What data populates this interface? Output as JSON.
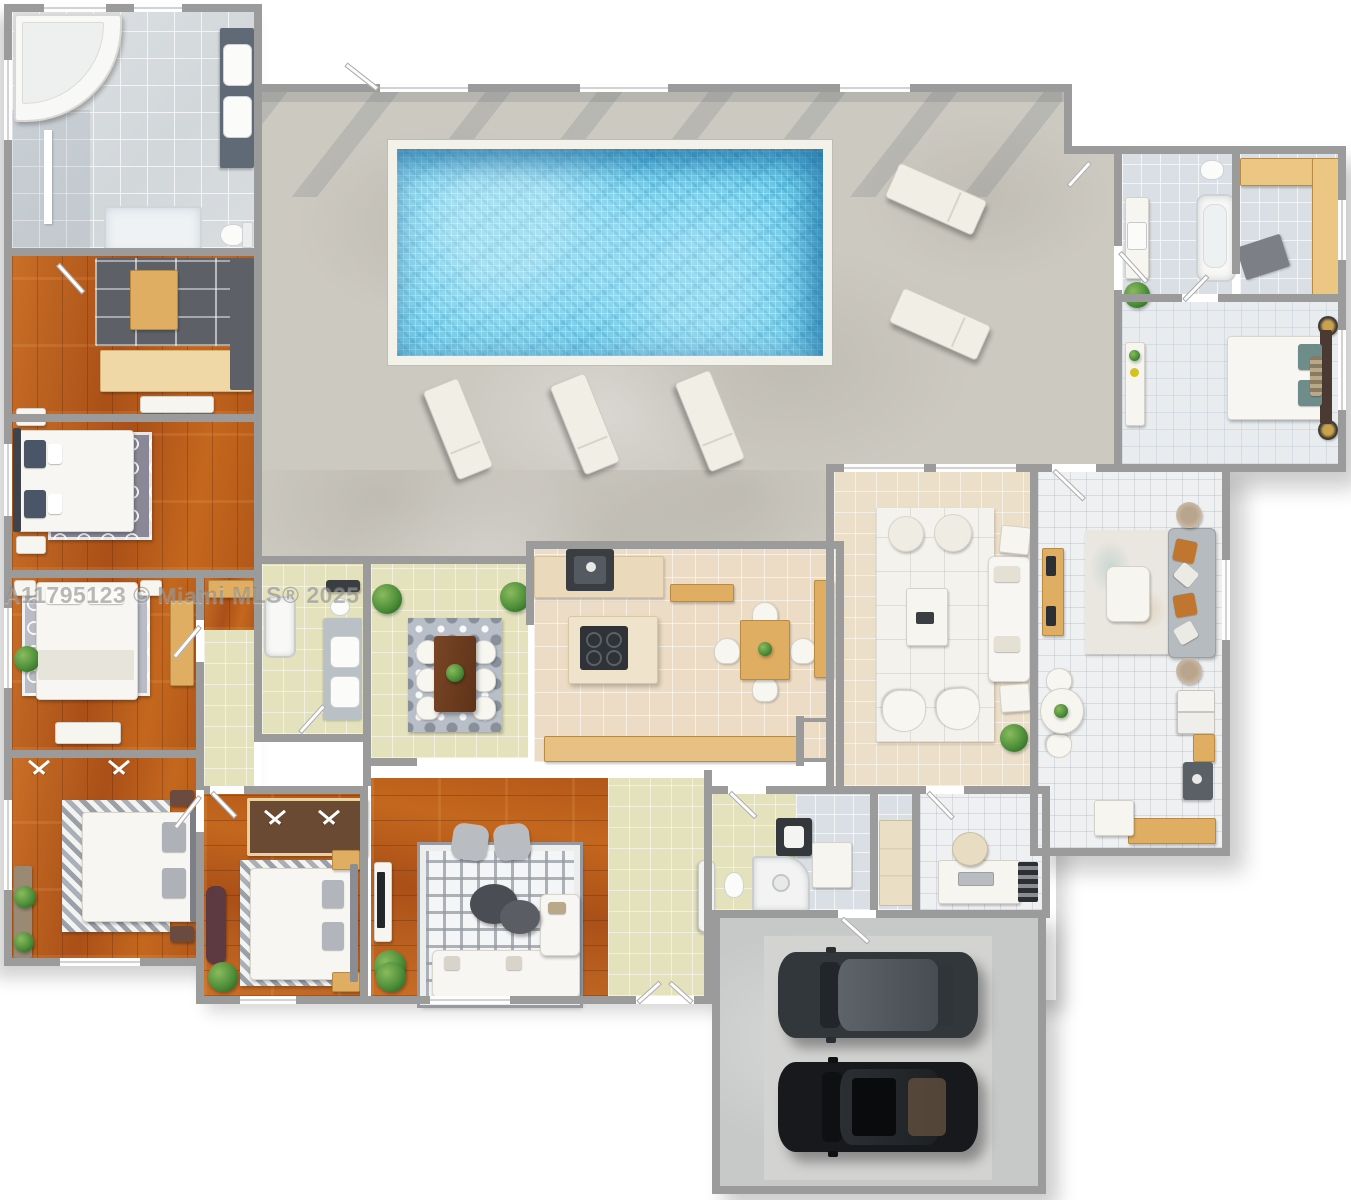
{
  "watermark": {
    "text": "A11795123 © Miami MLS® 2025"
  },
  "palette": {
    "wall": "#9b9b9b",
    "wood_floor": "#b85e1e",
    "pale_floor": "#e3e2bc",
    "warm_tile": "#ecdcc5",
    "cool_tile": "#d9dfe4",
    "white_tile": "#eef0f2",
    "concrete": "#ccc9c1",
    "pool_water": "#6ecbe8",
    "pool_coping": "#f2f1ea",
    "garage_floor": "#c7c9c8",
    "car_dark_gray": "#32373b",
    "car_black": "#17191c",
    "sofa_gray": "#b6bbbf",
    "pillow_orange": "#c0762e",
    "pillow_teal": "#6e8d8a",
    "pillow_navy": "#4a5668",
    "wood_furniture": "#e0ae62",
    "plant_green": "#4e8f3a"
  }
}
